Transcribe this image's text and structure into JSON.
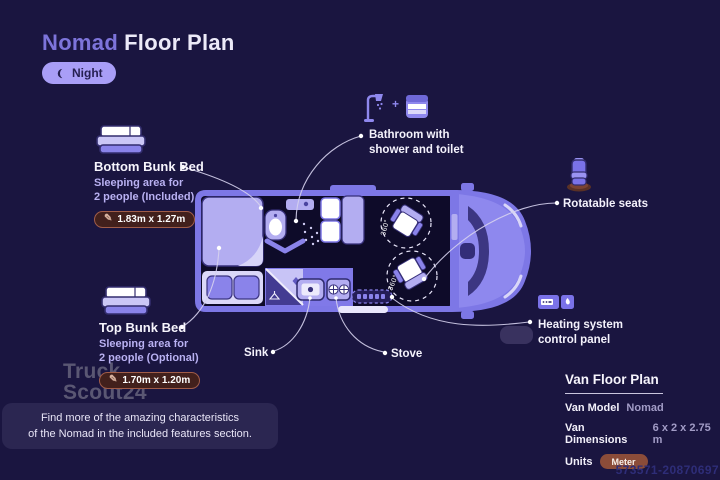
{
  "title": {
    "brand": "Nomad",
    "suffix": "Floor Plan"
  },
  "mode_toggle": {
    "label": "Night"
  },
  "callouts": {
    "bottom_bunk": {
      "title": "Bottom Bunk Bed",
      "desc_line1": "Sleeping area for",
      "desc_line2": "2 people (Included)",
      "dimensions": "1.83m x 1.27m"
    },
    "top_bunk": {
      "title": "Top Bunk Bed",
      "desc_line1": "Sleeping area for",
      "desc_line2": "2 people (Optional)",
      "dimensions": "1.70m x 1.20m"
    },
    "bathroom": {
      "plus": "+",
      "line1": "Bathroom with",
      "line2": "shower and toilet"
    },
    "rotatable_seats": {
      "label": "Rotatable seats"
    },
    "heating": {
      "line1": "Heating system",
      "line2": "control panel"
    },
    "sink": {
      "label": "Sink"
    },
    "stove": {
      "label": "Stove"
    }
  },
  "van": {
    "rotation_label": "360°"
  },
  "info_panel": {
    "title": "Van Floor Plan",
    "rows": [
      {
        "label": "Van Model",
        "value": "Nomad"
      },
      {
        "label": "Van Dimensions",
        "value": "6 x 2 x 2.75 m"
      },
      {
        "label": "Units",
        "value": "Meter"
      }
    ]
  },
  "footer_note": {
    "line1": "Find more of the amazing characteristics",
    "line2": "of the Nomad in the included features section."
  },
  "watermark": {
    "line1": "Truck",
    "line2": "Scout24"
  },
  "listing_id": "573571-20870697",
  "colors": {
    "background": "#1a1540",
    "accent": "#7d74da",
    "night_pill": "#a99ef7",
    "badge_bg": "#42201c",
    "badge_border": "#a05c48",
    "meter_pill": "#8b4c39",
    "van_body": "#7d77e6"
  }
}
